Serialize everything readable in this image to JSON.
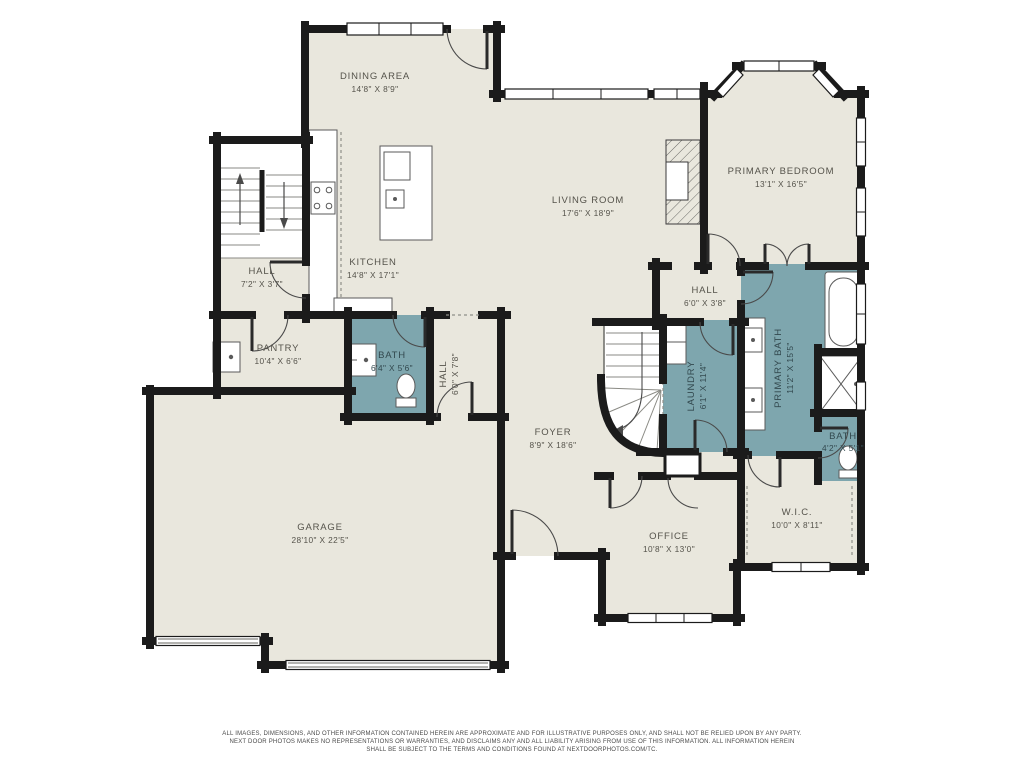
{
  "colors": {
    "background": "#ffffff",
    "floor": "#e9e7dd",
    "wet_room": "#7ea6ae",
    "wall": "#1b1b1b",
    "label": "#55534b",
    "label_wet": "#33494f"
  },
  "rooms": {
    "dining": {
      "name": "DINING AREA",
      "dims": "14'8\" X 8'9\""
    },
    "living": {
      "name": "LIVING ROOM",
      "dims": "17'6\" X 18'9\""
    },
    "primary_bedroom": {
      "name": "PRIMARY BEDROOM",
      "dims": "13'1\" X 16'5\""
    },
    "kitchen": {
      "name": "KITCHEN",
      "dims": "14'8\" X 17'1\""
    },
    "hall_stairs": {
      "name": "HALL",
      "dims": "7'2\" X 3'7\""
    },
    "pantry": {
      "name": "PANTRY",
      "dims": "10'4\" X 6'6\""
    },
    "bath_main": {
      "name": "BATH",
      "dims": "6'4\" X 5'6\""
    },
    "hall_mud": {
      "name": "HALL",
      "dims": "6'0\" X 7'8\""
    },
    "hall_bedroom": {
      "name": "HALL",
      "dims": "6'0\" X 3'8\""
    },
    "laundry": {
      "name": "LAUNDRY",
      "dims": "6'1\" X 11'4\""
    },
    "primary_bath": {
      "name": "PRIMARY BATH",
      "dims": "11'2\" X 15'5\""
    },
    "bath_small": {
      "name": "BATH",
      "dims": "4'2\" X 5'1\""
    },
    "foyer": {
      "name": "FOYER",
      "dims": "8'9\" X 18'6\""
    },
    "office": {
      "name": "OFFICE",
      "dims": "10'8\" X 13'0\""
    },
    "wic": {
      "name": "W.I.C.",
      "dims": "10'0\" X 8'11\""
    },
    "garage": {
      "name": "GARAGE",
      "dims": "28'10\" X 22'5\""
    }
  },
  "footer": {
    "line1": "ALL IMAGES, DIMENSIONS, AND OTHER INFORMATION CONTAINED HEREIN ARE APPROXIMATE AND FOR ILLUSTRATIVE PURPOSES ONLY, AND SHALL NOT BE RELIED UPON BY ANY PARTY.",
    "line2": "NEXT DOOR PHOTOS MAKES NO REPRESENTATIONS OR WARRANTIES, AND DISCLAIMS ANY AND ALL LIABILITY ARISING FROM USE OF THIS INFORMATION. ALL INFORMATION HEREIN",
    "line3": "SHALL BE SUBJECT TO THE TERMS AND CONDITIONS FOUND AT NEXTDOORPHOTOS.COM/TC."
  }
}
